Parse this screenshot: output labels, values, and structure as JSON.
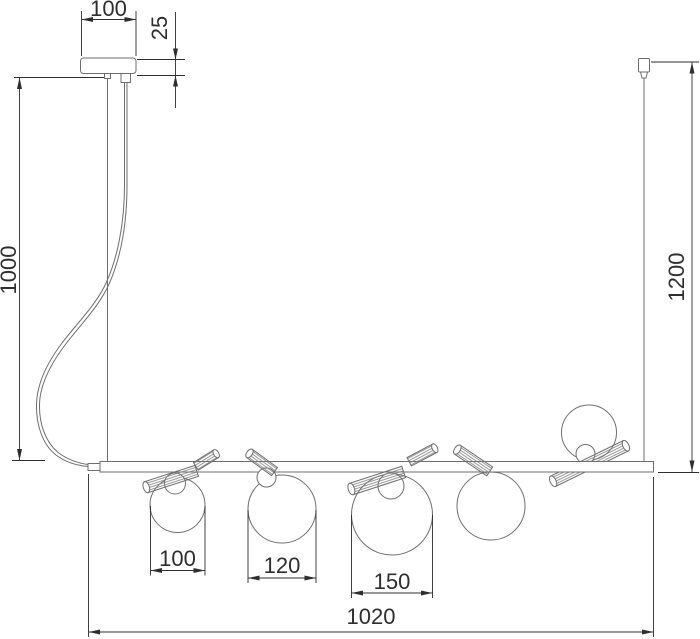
{
  "drawing": {
    "dimensions": {
      "canopy_width": "100",
      "canopy_height": "25",
      "suspension_length": "1000",
      "overall_height": "1200",
      "globe_small_diameter": "100",
      "globe_medium_diameter": "120",
      "globe_large_diameter": "150",
      "bar_length": "1020"
    },
    "colors": {
      "line": "#6e6e6e",
      "dimension": "#2e2e2e",
      "background": "#ffffff",
      "hatch": "#7a7a7a"
    }
  }
}
